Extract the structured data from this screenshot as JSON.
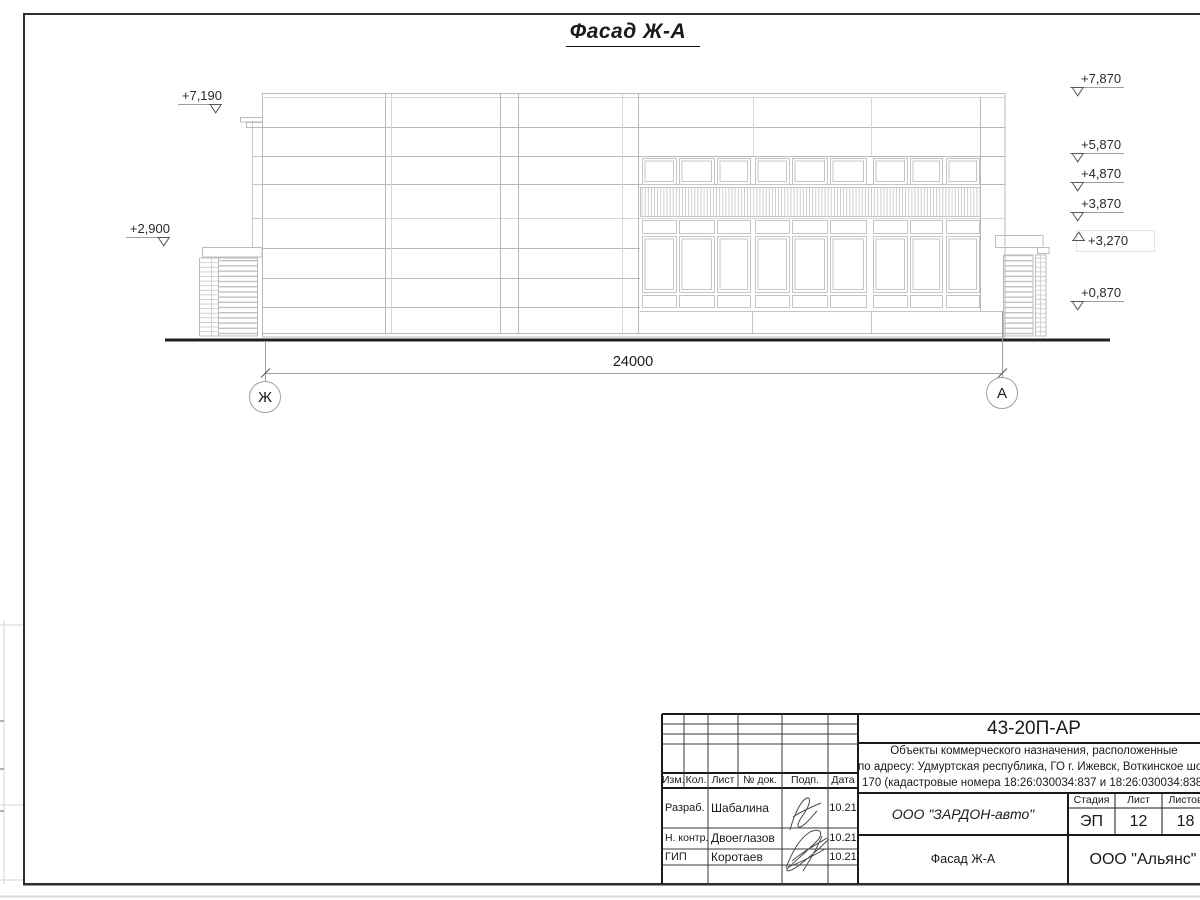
{
  "drawing": {
    "title": "Фасад Ж-А",
    "dimension_total": "24000",
    "axis_left": "Ж",
    "axis_right": "А",
    "elevations_left": [
      "+7,190",
      "+2,900"
    ],
    "elevations_right": [
      "+7,870",
      "+5,870",
      "+4,870",
      "+3,870",
      "+3,270",
      "+0,870"
    ]
  },
  "title_block": {
    "document_code": "43-20П-АР",
    "project_description_line1": "Объекты коммерческого назначения, расположенные",
    "project_description_line2": "по адресу: Удмуртская республика, ГО г. Ижевск, Воткинское шоссе",
    "project_description_line3": "170 (кадастровые номера 18:26:030034:837 и 18:26:030034:838)",
    "col_izm": "Изм.",
    "col_kol": "Кол.",
    "col_list": "Лист",
    "col_ndok": "№ док.",
    "col_podp": "Подп.",
    "col_data": "Дата",
    "row1_role": "Разраб.",
    "row1_name": "Шабалина",
    "row1_date": "10.21",
    "row2_role": "Н. контр.",
    "row2_name": "Двоеглазов",
    "row2_date": "10.21",
    "row3_role": "ГИП",
    "row3_name": "Коротаев",
    "row3_date": "10.21",
    "organization": "ООО \"ЗАРДОН-авто\"",
    "stage_label": "Стадия",
    "sheet_label": "Лист",
    "sheets_label": "Листов",
    "stage_value": "ЭП",
    "sheet_value": "12",
    "sheets_value": "18",
    "drawing_name": "Фасад Ж-А",
    "contractor": "ООО \"Альянс\""
  }
}
